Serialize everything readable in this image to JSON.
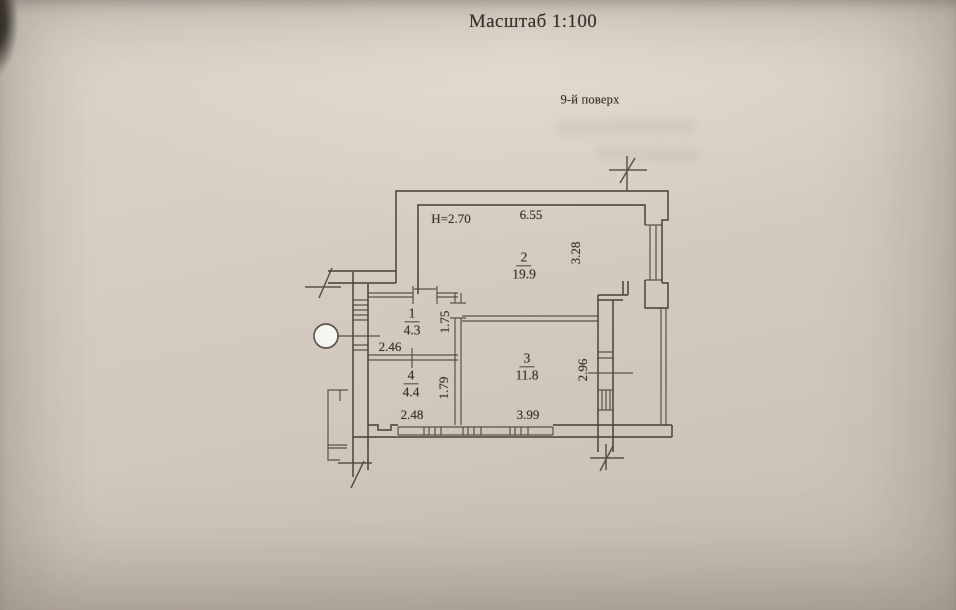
{
  "page": {
    "title": "Масштаб 1:100",
    "floor_label": "9-й поверх"
  },
  "plan": {
    "ceiling_height_label": "H=2.70",
    "rooms": [
      {
        "number": "1",
        "area": "4.3",
        "width_dim": "2.46",
        "depth_dim": "1.75"
      },
      {
        "number": "2",
        "area": "19.9",
        "width_dim": "6.55",
        "depth_dim": "3.28"
      },
      {
        "number": "3",
        "area": "11.8",
        "width_dim": "3.99",
        "depth_dim": "2.96"
      },
      {
        "number": "4",
        "area": "4.4",
        "width_dim": "2.48",
        "depth_dim": "1.79"
      }
    ]
  },
  "colors": {
    "paper": "#d3ccc1",
    "ink": "#48423a"
  }
}
